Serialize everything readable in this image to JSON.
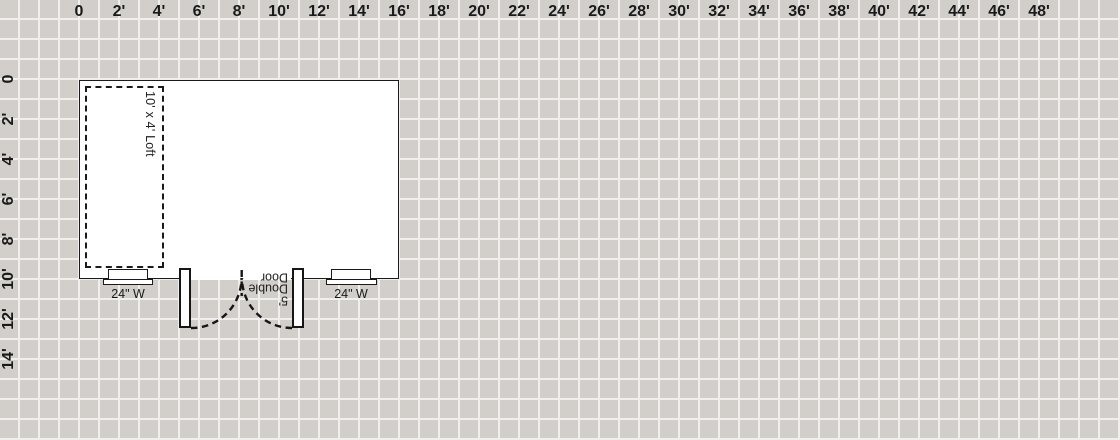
{
  "app": {
    "view": "floorplan-canvas"
  },
  "colors": {
    "canvas_bg": "#d2cfcb",
    "grid_line": "#f0efed",
    "ink": "#1a1a1a",
    "shape_fill": "#ffffff"
  },
  "grid": {
    "cell_feet": 1,
    "label_every_feet": 2
  },
  "rulers": {
    "top": {
      "labels": [
        "0",
        "2'",
        "4'",
        "6'",
        "8'",
        "10'",
        "12'",
        "14'",
        "16'",
        "18'",
        "20'",
        "22'",
        "24'",
        "26'",
        "28'",
        "30'",
        "32'",
        "34'",
        "36'",
        "38'",
        "40'",
        "42'",
        "44'",
        "46'",
        "48'"
      ]
    },
    "left": {
      "labels": [
        "0",
        "2'",
        "4'",
        "6'",
        "8'",
        "10'",
        "12'",
        "14'"
      ]
    }
  },
  "plan": {
    "loft": {
      "label": "10' x 4' Loft"
    },
    "windows": [
      {
        "label": "24\" W"
      },
      {
        "label": "24\" W"
      }
    ],
    "door": {
      "label": "5'\nDouble\nDoor",
      "reading": "5' Double Door"
    }
  }
}
